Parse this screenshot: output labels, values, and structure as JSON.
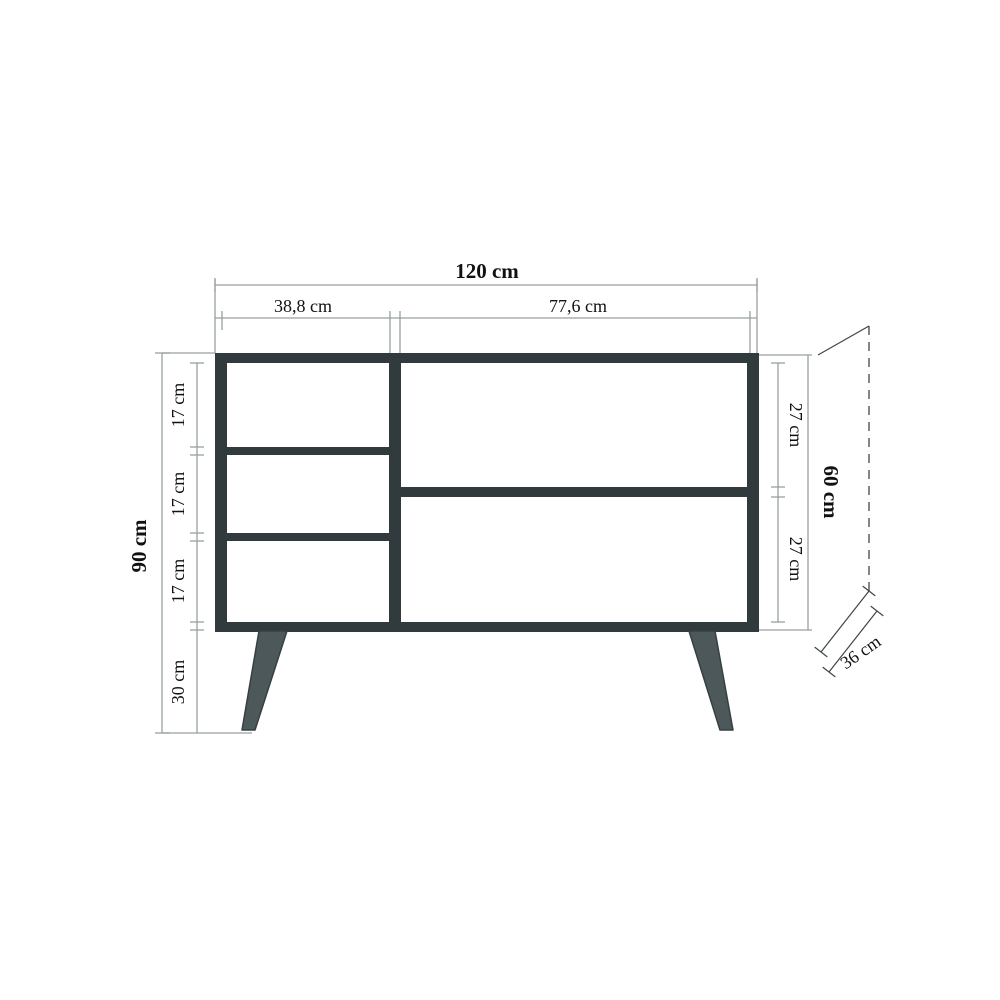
{
  "diagram": {
    "type": "furniture-dimension-drawing",
    "subject": "sideboard front elevation with depth projection",
    "units": "cm",
    "labels": {
      "width_total": "120 cm",
      "width_left_section": "38,8 cm",
      "width_right_section": "77,6 cm",
      "height_total": "90 cm",
      "left_shelf_1": "17 cm",
      "left_shelf_2": "17 cm",
      "left_shelf_3": "17 cm",
      "leg_height": "30 cm",
      "right_compartment_top": "27 cm",
      "right_compartment_bottom": "27 cm",
      "body_height": "60 cm",
      "depth": "36 cm"
    },
    "dimensions_cm": {
      "total_width": 120,
      "left_section_width": 38.8,
      "right_section_width": 77.6,
      "total_height": 90,
      "body_height": 60,
      "leg_height": 30,
      "left_shelf_heights": [
        17,
        17,
        17
      ],
      "right_compartment_heights": [
        27,
        27
      ],
      "depth": 36
    },
    "colors": {
      "background": "#ffffff",
      "frame": "#313a3c",
      "leg_fill": "#4d585a",
      "leg_stroke": "#364042",
      "dimension_line": "#98a0a0",
      "projection_line": "#3f4648",
      "text": "#111111"
    }
  }
}
